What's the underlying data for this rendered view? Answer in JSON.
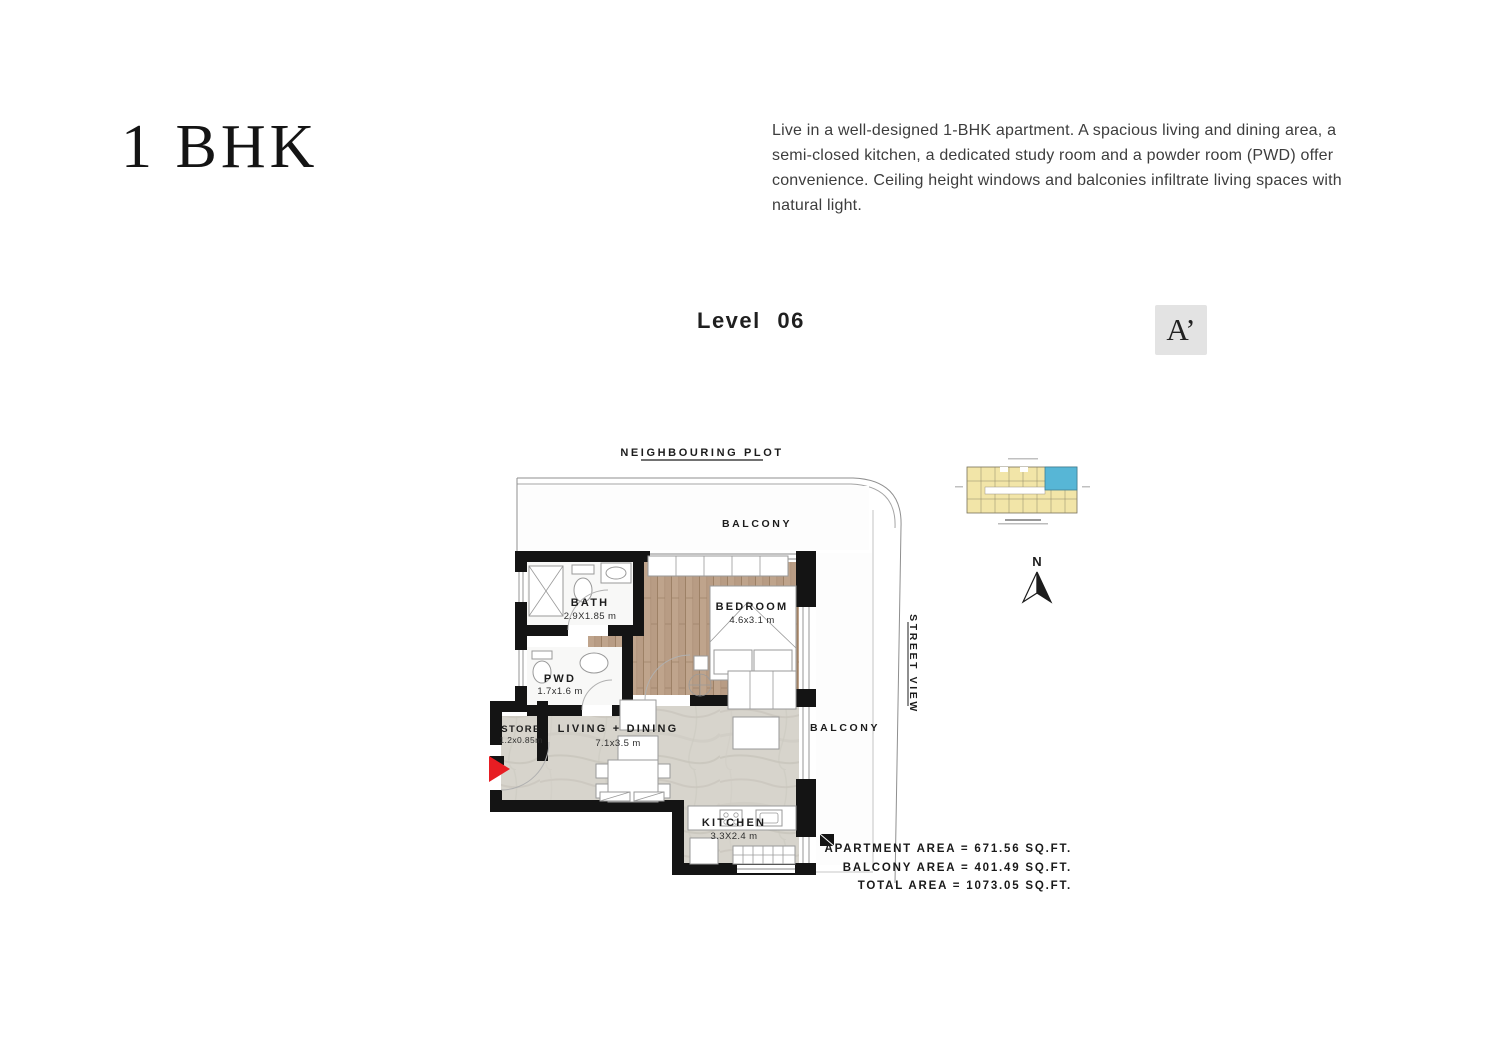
{
  "header": {
    "title": "1 BHK",
    "description": "Live in a well-designed 1-BHK apartment. A spacious living and dining area, a semi-closed kitchen, a dedicated study room and a powder room (PWD) offer convenience. Ceiling height windows and balconies infiltrate living spaces with natural light."
  },
  "level": {
    "label": "Level 06",
    "section_marker": "A’"
  },
  "plan": {
    "neighbouring_plot": "NEIGHBOURING PLOT",
    "street_view": "STREET VIEW",
    "balcony_top": "BALCONY",
    "balcony_right": "BALCONY",
    "compass_north": "N",
    "rooms": [
      {
        "name": "BATH",
        "dims": "2.9X1.85 m"
      },
      {
        "name": "PWD",
        "dims": "1.7x1.6 m"
      },
      {
        "name": "STORE",
        "dims": "1.2x0.85m"
      },
      {
        "name": "BEDROOM",
        "dims": "4.6x3.1 m"
      },
      {
        "name": "LIVING + DINING",
        "dims": "7.1x3.5 m"
      },
      {
        "name": "KITCHEN",
        "dims": "3.3X2.4 m"
      }
    ]
  },
  "areas": {
    "apartment": "APARTMENT AREA = 671.56 SQ.FT.",
    "balcony": "BALCONY AREA = 401.49 SQ.FT.",
    "total": "TOTAL AREA = 1073.05 SQ.FT."
  },
  "colors": {
    "wall": "#141414",
    "wood_floor": "#b89c84",
    "stone_floor": "#d7d4cc",
    "entrance_arrow": "#e71d23",
    "keyplan_unit": "#f2e5a8",
    "keyplan_highlight": "#57b6d6",
    "marker_background": "#e3e3e3"
  }
}
